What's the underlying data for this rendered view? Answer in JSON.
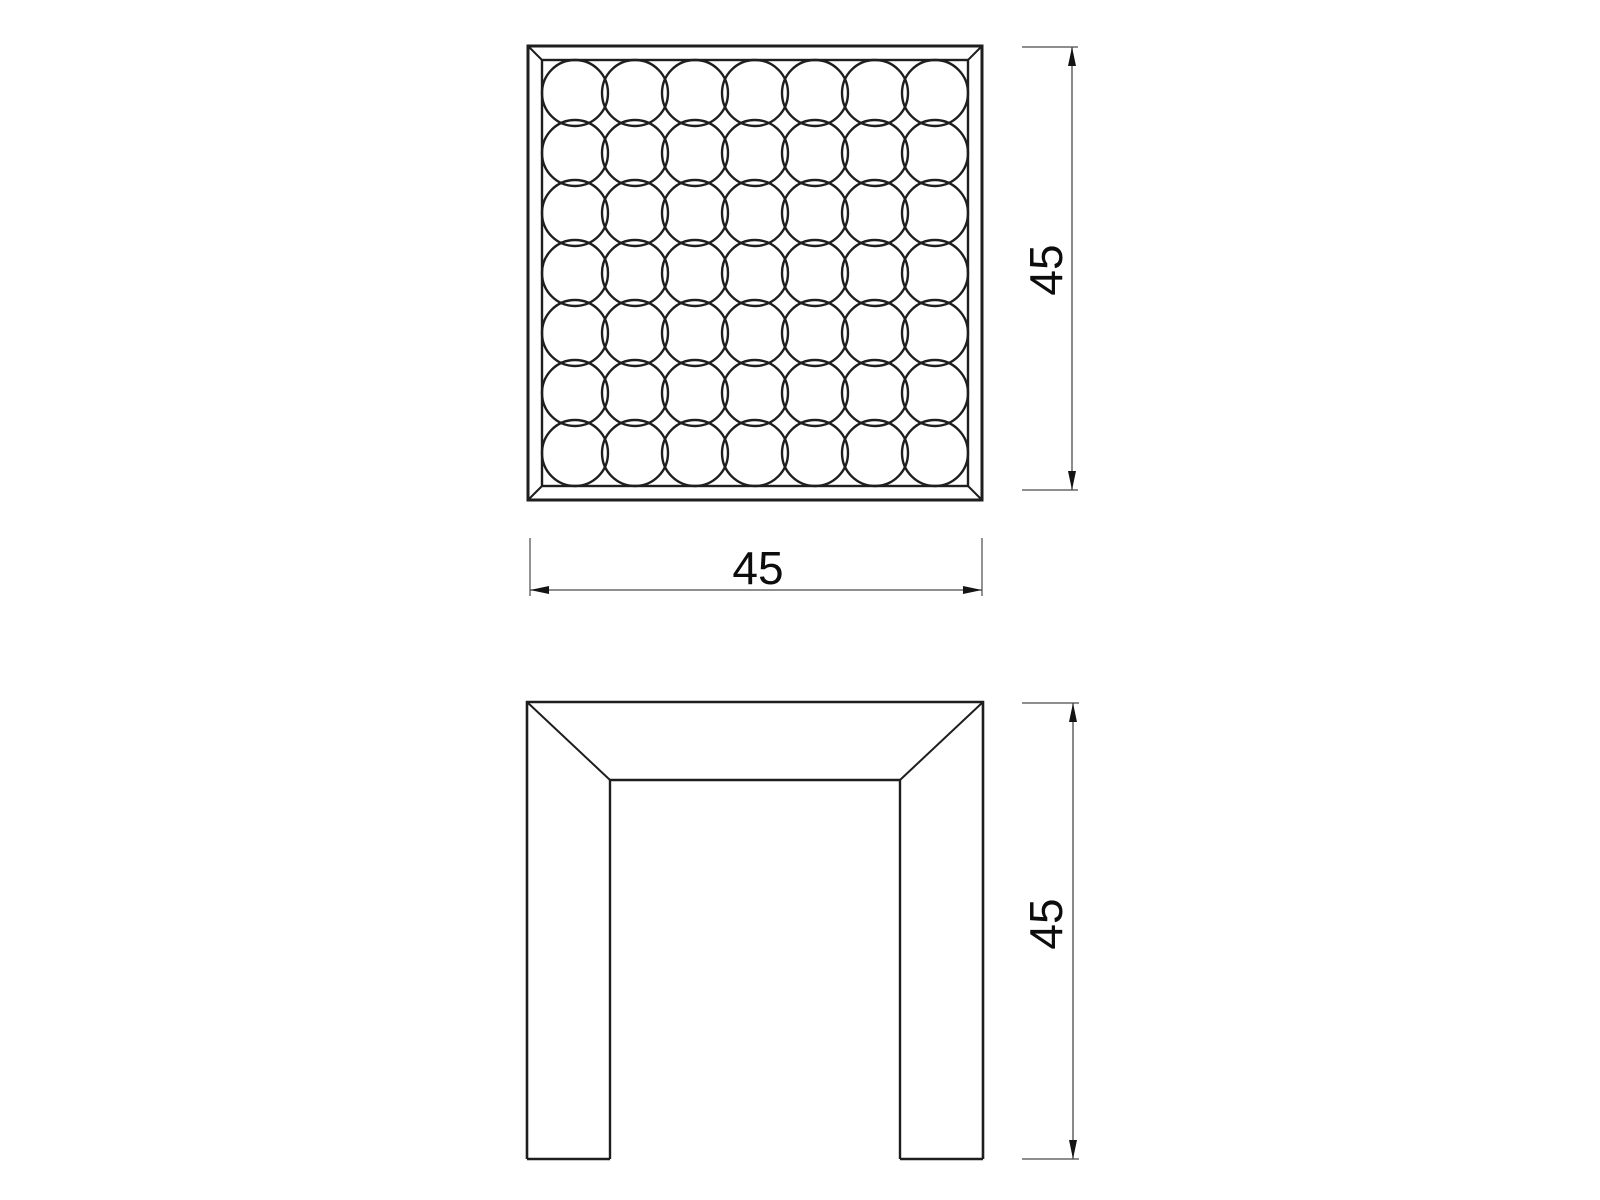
{
  "page": {
    "background_color": "#ffffff"
  },
  "drawing": {
    "type": "technical-dimension-drawing",
    "line_color": "#1e1e1e",
    "dimension_color": "#4a4a4a",
    "text_color": "#0d0d0d",
    "top_view": {
      "pattern": {
        "type": "circle-grid",
        "rows": 7,
        "cols": 7,
        "circle_count": 49
      },
      "height_dimension": {
        "value": "45",
        "orientation": "vertical"
      },
      "width_dimension": {
        "value": "45",
        "orientation": "horizontal"
      }
    },
    "front_view": {
      "height_dimension": {
        "value": "45",
        "orientation": "vertical"
      }
    }
  }
}
